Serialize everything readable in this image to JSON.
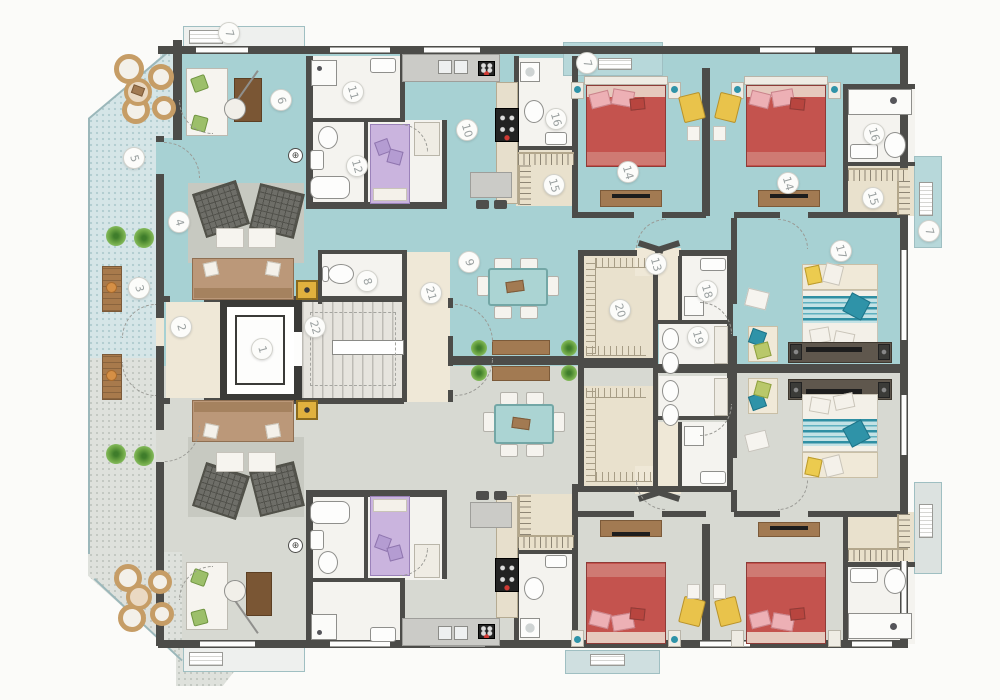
{
  "plan": {
    "type": "residential-apartment-floor-plan",
    "view": "top-down 2D color plan"
  },
  "room_labels": [
    {
      "n": "1",
      "x": 262,
      "y": 349
    },
    {
      "n": "2",
      "x": 181,
      "y": 327
    },
    {
      "n": "3",
      "x": 139,
      "y": 288
    },
    {
      "n": "4",
      "x": 179,
      "y": 222
    },
    {
      "n": "5",
      "x": 134,
      "y": 158
    },
    {
      "n": "6",
      "x": 281,
      "y": 100
    },
    {
      "n": "7",
      "x": 229,
      "y": 33
    },
    {
      "n": "7",
      "x": 587,
      "y": 63
    },
    {
      "n": "7",
      "x": 929,
      "y": 231
    },
    {
      "n": "8",
      "x": 367,
      "y": 281
    },
    {
      "n": "9",
      "x": 469,
      "y": 262
    },
    {
      "n": "10",
      "x": 467,
      "y": 130
    },
    {
      "n": "11",
      "x": 353,
      "y": 92
    },
    {
      "n": "12",
      "x": 357,
      "y": 166
    },
    {
      "n": "13",
      "x": 656,
      "y": 264
    },
    {
      "n": "14",
      "x": 628,
      "y": 172
    },
    {
      "n": "14",
      "x": 788,
      "y": 183
    },
    {
      "n": "15",
      "x": 554,
      "y": 185
    },
    {
      "n": "15",
      "x": 873,
      "y": 198
    },
    {
      "n": "16",
      "x": 556,
      "y": 119
    },
    {
      "n": "16",
      "x": 874,
      "y": 134
    },
    {
      "n": "17",
      "x": 841,
      "y": 251
    },
    {
      "n": "18",
      "x": 707,
      "y": 291
    },
    {
      "n": "19",
      "x": 698,
      "y": 337
    },
    {
      "n": "20",
      "x": 620,
      "y": 310
    },
    {
      "n": "21",
      "x": 431,
      "y": 293
    },
    {
      "n": "22",
      "x": 315,
      "y": 327
    }
  ],
  "icons": {
    "door_sensor": "⊕"
  },
  "colors": {
    "upper_unit_floor": "#a7d1d3",
    "lower_unit_floor": "#d7d9d2",
    "terrace": "#d5e5e7",
    "walls": "#4c4c49",
    "hall_beige": "#efe8d7",
    "closet_beige": "#e9e1cd",
    "bed_red": "#c4534e",
    "bed_pink": "#edb0b5",
    "bed_purple": "#cab4de",
    "accent_yellow": "#e9c34b",
    "accent_teal": "#2f93a8",
    "wood": "#a27a52"
  }
}
